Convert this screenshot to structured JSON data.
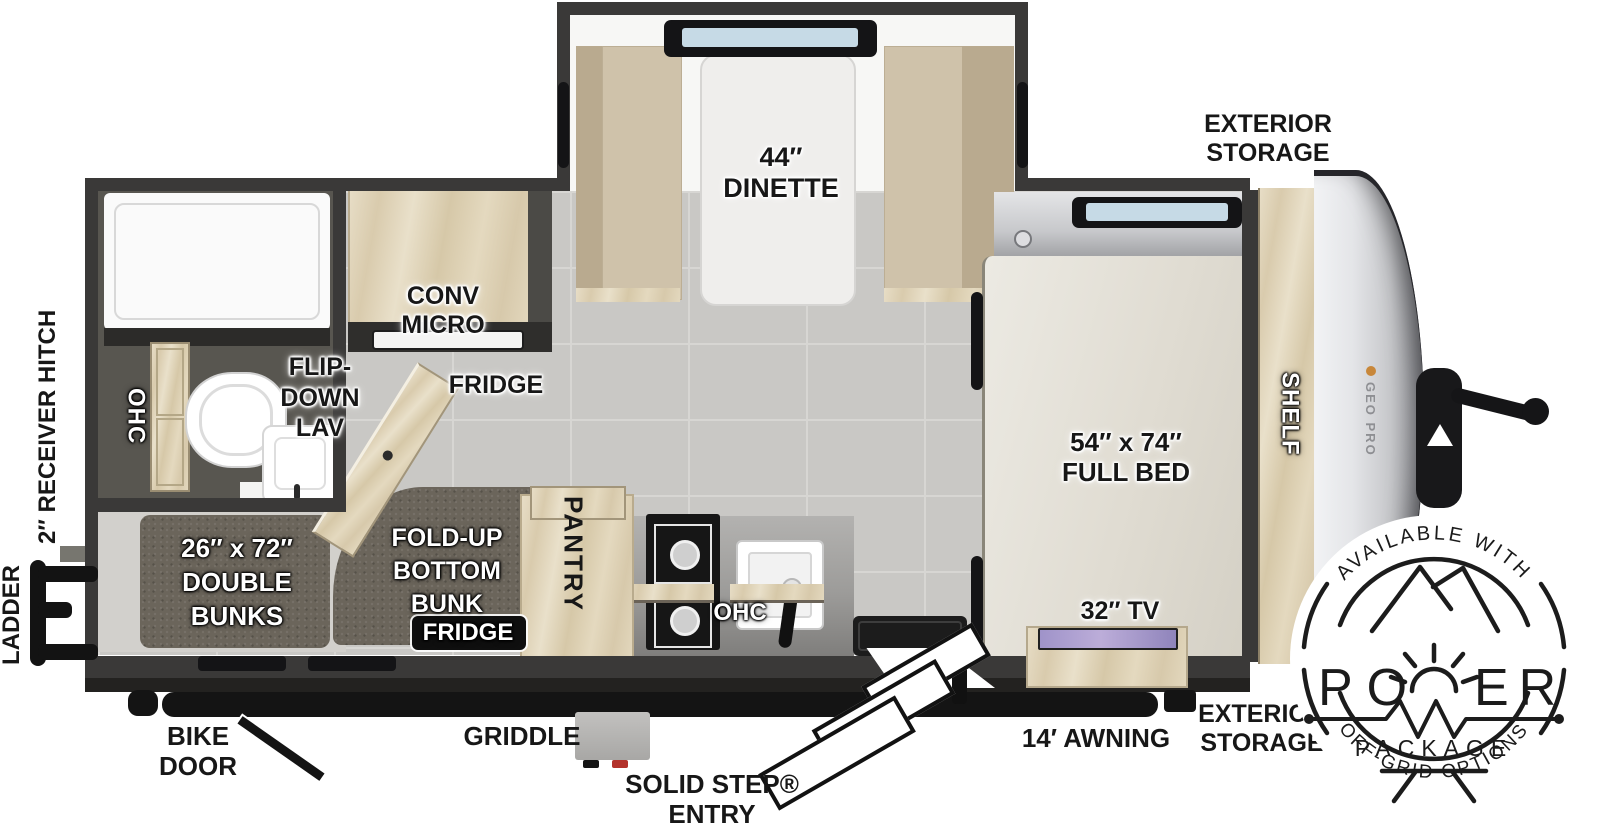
{
  "exterior": {
    "storage_top": [
      "EXTERIOR",
      "STORAGE"
    ],
    "storage_bottom": [
      "EXTERIOR",
      "STORAGE"
    ],
    "awning": "14′ AWNING",
    "solid_step": [
      "SOLID STEP®",
      "ENTRY"
    ],
    "griddle": "GRIDDLE",
    "bike_door": [
      "BIKE",
      "DOOR"
    ],
    "ladder": "LADDER",
    "receiver_hitch": "2″ RECEIVER HITCH",
    "brand": "GEO PRO"
  },
  "interior": {
    "dinette": [
      "44″",
      "DINETTE"
    ],
    "conv_micro": [
      "CONV",
      "MICRO"
    ],
    "fridge_upper": "FRIDGE",
    "flip_down_lav": [
      "FLIP-",
      "DOWN",
      "LAV"
    ],
    "ohc_bath": "OHC",
    "double_bunks": [
      "26″ x 72″",
      "DOUBLE",
      "BUNKS"
    ],
    "fold_up_bunk": [
      "FOLD-UP",
      "BOTTOM",
      "BUNK"
    ],
    "fridge_lower": "FRIDGE",
    "pantry": "PANTRY",
    "ohc_kitchen": "OHC",
    "full_bed": [
      "54″ x 74″",
      "FULL BED"
    ],
    "shelf": "SHELF",
    "tv": "32″ TV"
  },
  "badge": {
    "top": "AVAILABLE WITH",
    "power_left": "PO",
    "power_right": "ER",
    "package": "PACKAGE",
    "bottom": "OFF-GRID OPTIONS"
  },
  "colors": {
    "wall": "#3a3938",
    "floor_tile": "#c9c8c5",
    "wood": "#ddd0b4",
    "mattress": "#6b655b",
    "bed": "#e7e3da",
    "awning": "#141414",
    "front_cap": "#c6c7ca"
  }
}
